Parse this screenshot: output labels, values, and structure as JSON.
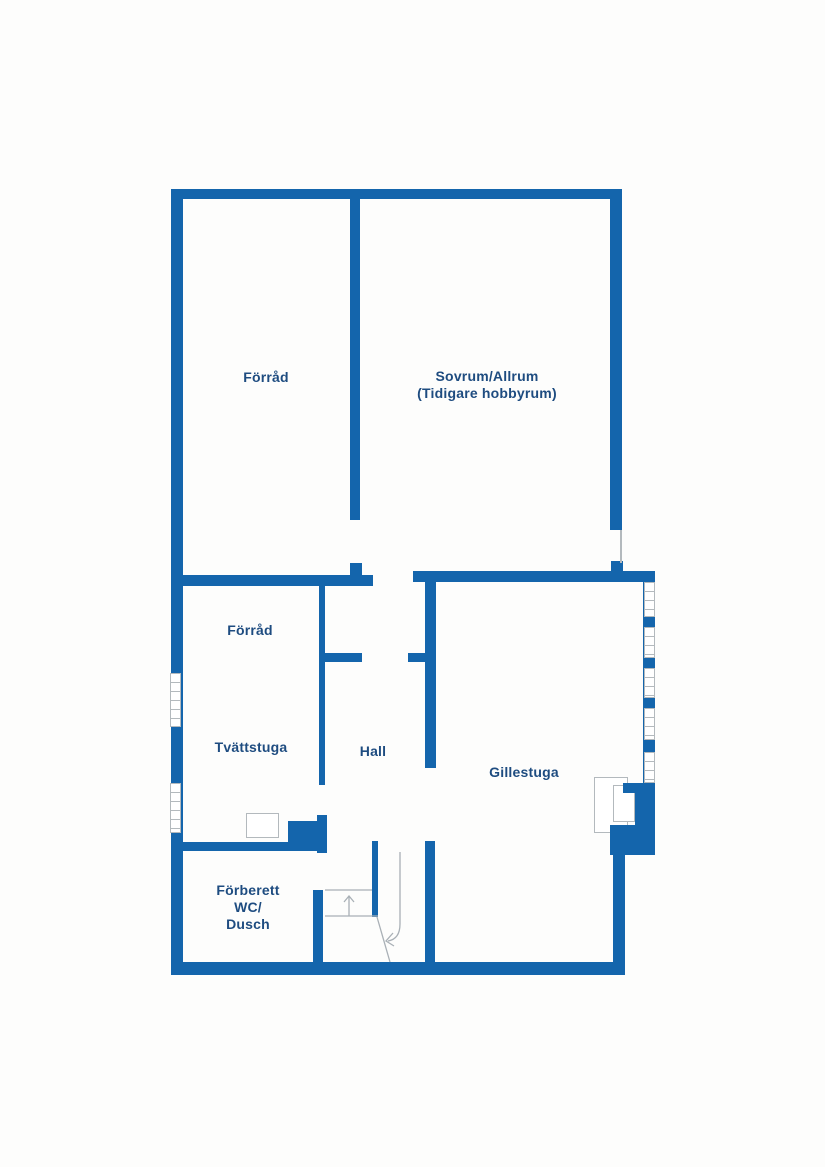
{
  "type": "floor-plan",
  "floor": "basement",
  "colors": {
    "wall": "#1465ac",
    "label": "#1e4c80",
    "line": "#b3b9bd",
    "stair": "#a9b0b6",
    "background": "#fdfdfc"
  },
  "rooms": {
    "forrad_upper": {
      "label": "Förråd"
    },
    "sovrum": {
      "label": "Sovrum/Allrum",
      "label2": "(Tidigare hobbyrum)"
    },
    "forrad_lower": {
      "label": "Förråd"
    },
    "tvattstuga": {
      "label": "Tvättstuga"
    },
    "hall": {
      "label": "Hall"
    },
    "gillestuga": {
      "label": "Gillestuga"
    },
    "wc": {
      "label": "Förberett",
      "label2": "WC/",
      "label3": "Dusch"
    }
  },
  "icons": {
    "stair_up_arrow": "arrow-up",
    "stair_down_arrow": "arrow-curve-down-left"
  }
}
